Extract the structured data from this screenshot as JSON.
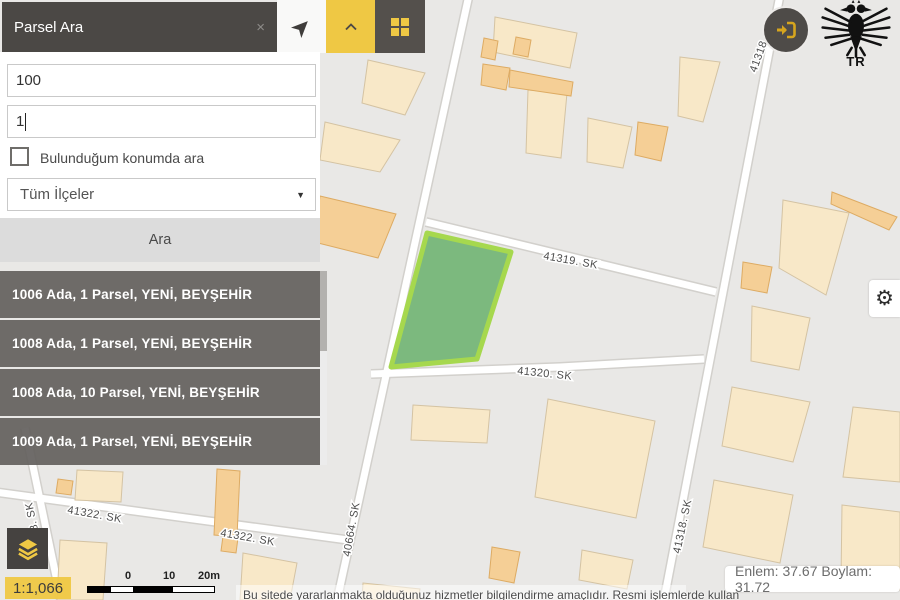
{
  "panel": {
    "title": "Parsel Ara",
    "inputs": {
      "ada": "100",
      "parsel": "1"
    },
    "checkbox_label": "Bulunduğum konumda ara",
    "district": "Tüm İlçeler",
    "search": "Ara",
    "results": [
      {
        "label": "1006 Ada, 1 Parsel, YENİ, BEYŞEHİR"
      },
      {
        "label": "1008 Ada, 1 Parsel, YENİ, BEYŞEHİR"
      },
      {
        "label": "1008 Ada, 10 Parsel, YENİ, BEYŞEHİR"
      },
      {
        "label": "1009 Ada, 1 Parsel, YENİ, BEYŞEHİR"
      }
    ]
  },
  "icons": {
    "close": "×",
    "caret": "▼",
    "gear": "⚙"
  },
  "map": {
    "street_labels": [
      "41319. SK",
      "41320. SK",
      "41322. SK",
      "41322. SK",
      "8. SK",
      "40664. SK",
      "41318. SK",
      "41318"
    ],
    "scale": {
      "ratio": "1:1,066",
      "t0": "0",
      "t10": "10",
      "t20": "20m"
    },
    "coords": "Enlem: 37.67 Boylam: 31.72",
    "disclaimer": "Bu sitede yararlanmakta olduğunuz hizmetler bilgilendirme amaçlıdır. Resmi işlemlerde kullan"
  },
  "logo": {
    "text": "TR"
  },
  "colors": {
    "accent_yellow": "#efc844",
    "panel_dark": "#4b4845",
    "parcel_fill": "#7cb97e",
    "parcel_stroke": "#a6d84e",
    "building_light": "#f8e8c8",
    "building_tan": "#f5cf96"
  }
}
